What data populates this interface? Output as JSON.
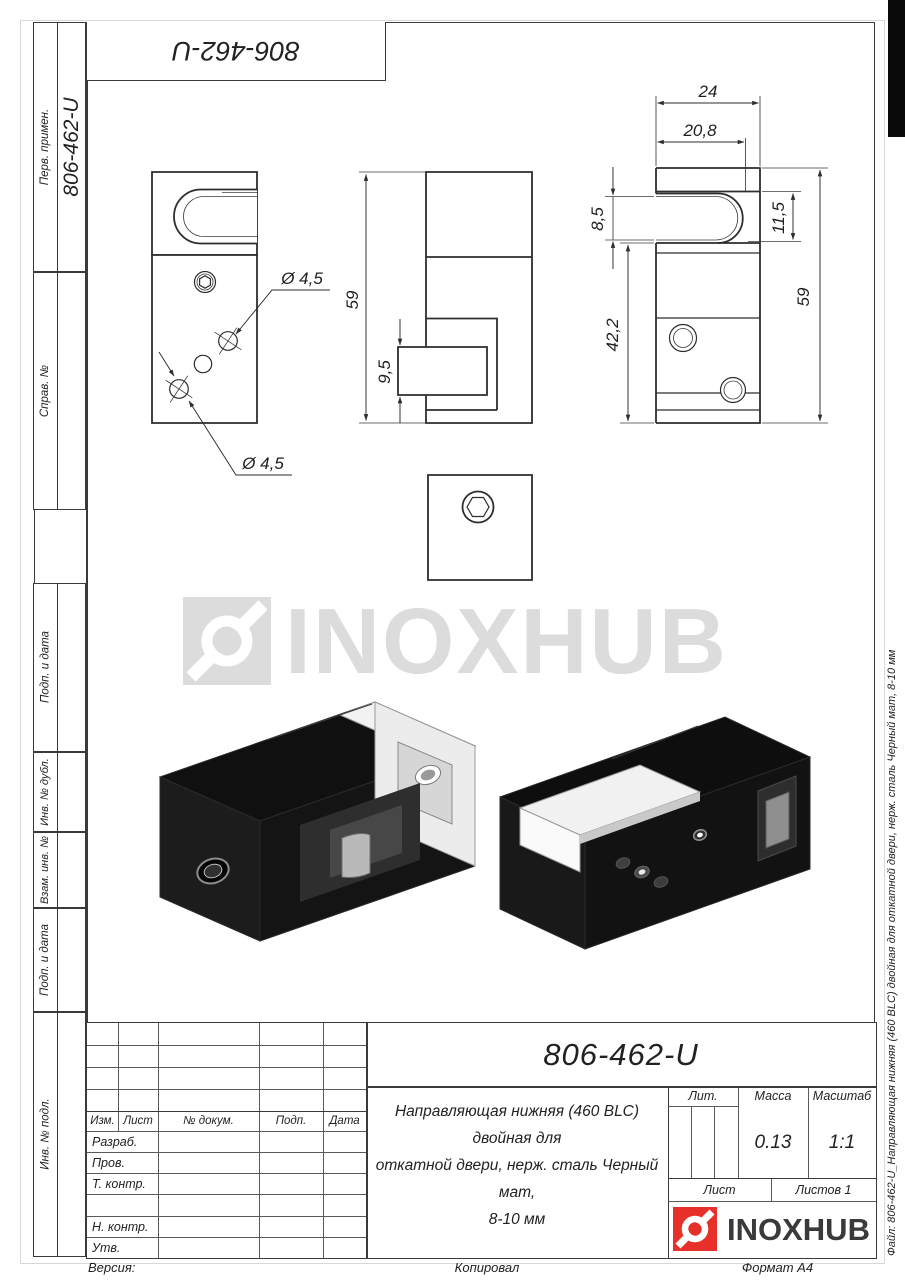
{
  "sheet": {
    "top_designation": "806-462-U",
    "version_label": "Версия:",
    "copied_label": "Копировал",
    "format_label": "Формат А4",
    "file_note": "Файл: 806-462-U_Направляющая нижняя (460 BLC) двойная для откатной двери, нерж. сталь Черный мат, 8-10 мм"
  },
  "stamps": {
    "perv_primen": {
      "label": "Перв. примен.",
      "value": "806-462-U"
    },
    "sprav": {
      "label": "Справ. №"
    },
    "podp_data_1": {
      "label": "Подп. и дата"
    },
    "inv_dubl": {
      "label": "Инв. № дубл."
    },
    "vzam_inv": {
      "label": "Взам. инв. №"
    },
    "podp_data_2": {
      "label": "Подп. и дата"
    },
    "inv_podl": {
      "label": "Инв. № подл."
    }
  },
  "drawing": {
    "watermark_text": "INOXHUB",
    "dims": {
      "dia_hole_top": "Ø 4,5",
      "dia_hole_bottom": "Ø 4,5",
      "height_side": "59",
      "slot_depth_side": "9,5",
      "width_top": "24",
      "width_slot_inner": "20,8",
      "slot_gap": "8,5",
      "slot_height": "11,5",
      "body_height": "42,2",
      "height_front": "59"
    }
  },
  "title_block": {
    "designation": "806-462-U",
    "description_lines": [
      "Направляющая нижняя (460 BLC) двойная для",
      "откатной двери, нерж. сталь Черный мат,",
      "8-10 мм"
    ],
    "headers": {
      "izm": "Изм.",
      "list": "Лист",
      "n_dokum": "№ докум.",
      "podp": "Подп.",
      "data": "Дата"
    },
    "rows": {
      "razrab": "Разраб.",
      "prov": "Пров.",
      "t_kontr": "Т. контр.",
      "n_kontr": "Н. контр.",
      "utv": "Утв."
    },
    "lit_label": "Лит.",
    "massa_label": "Масса",
    "massa_value": "0.13",
    "masshtab_label": "Масштаб",
    "masshtab_value": "1:1",
    "list_label": "Лист",
    "listov_label": "Листов 1",
    "logo_text": "INOXHUB"
  }
}
